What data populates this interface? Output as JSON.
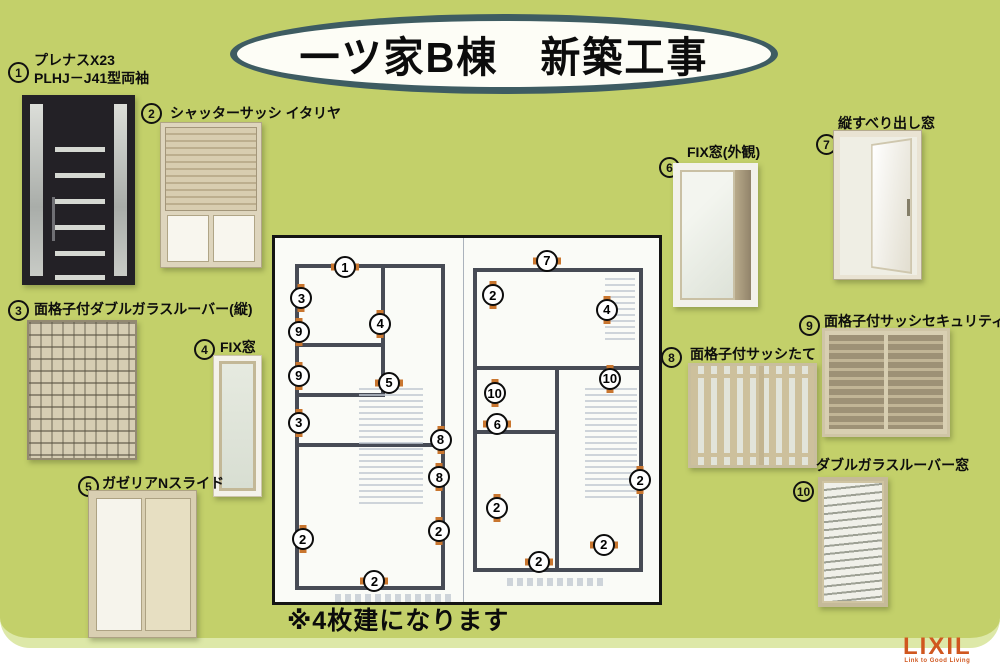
{
  "title": "一ツ家B棟　新築工事",
  "note": "※4枚建になります",
  "colors": {
    "background_green": "#c3d06a",
    "oval_border": "#3e5c62",
    "window_marker_orange": "#c9762f",
    "logo_orange": "#d0571f"
  },
  "logo": {
    "text": "LIXIL",
    "tagline": "Link to Good Living"
  },
  "products": [
    {
      "num": "1",
      "label": "プレナスX23",
      "label2": "PLHJ－J41型両袖"
    },
    {
      "num": "2",
      "label": "シャッターサッシ イタリヤ"
    },
    {
      "num": "3",
      "label": "面格子付ダブルガラスルーバー(縦)"
    },
    {
      "num": "4",
      "label": "FIX窓"
    },
    {
      "num": "5",
      "label": "ガゼリアNスライド"
    },
    {
      "num": "6",
      "label": "FIX窓(外観)"
    },
    {
      "num": "7",
      "label": "縦すべり出し窓"
    },
    {
      "num": "8",
      "label": "面格子付サッシたて"
    },
    {
      "num": "9",
      "label": "面格子付サッシセキュリティー"
    },
    {
      "num": "10",
      "label": "ダブルガラスルーバー窓"
    }
  ],
  "floorplan": {
    "markers": [
      {
        "n": "1",
        "x": 18.2,
        "y": 8.1,
        "dir": "h"
      },
      {
        "n": "3",
        "x": 6.9,
        "y": 16.5,
        "dir": "v"
      },
      {
        "n": "9",
        "x": 6.2,
        "y": 25.7,
        "dir": "v"
      },
      {
        "n": "4",
        "x": 27.4,
        "y": 23.5,
        "dir": "v"
      },
      {
        "n": "9",
        "x": 6.2,
        "y": 37.8,
        "dir": "v"
      },
      {
        "n": "5",
        "x": 29.7,
        "y": 39.7,
        "dir": "h"
      },
      {
        "n": "3",
        "x": 6.2,
        "y": 50.8,
        "dir": "v"
      },
      {
        "n": "8",
        "x": 43.1,
        "y": 55.4,
        "dir": "v"
      },
      {
        "n": "8",
        "x": 42.8,
        "y": 65.7,
        "dir": "v"
      },
      {
        "n": "2",
        "x": 7.2,
        "y": 82.7,
        "dir": "v"
      },
      {
        "n": "2",
        "x": 42.6,
        "y": 80.5,
        "dir": "v"
      },
      {
        "n": "2",
        "x": 25.9,
        "y": 94.3,
        "dir": "h"
      },
      {
        "n": "7",
        "x": 70.8,
        "y": 6.2,
        "dir": "h"
      },
      {
        "n": "2",
        "x": 56.7,
        "y": 15.7,
        "dir": "v"
      },
      {
        "n": "4",
        "x": 86.4,
        "y": 19.7,
        "dir": "v"
      },
      {
        "n": "10",
        "x": 87.2,
        "y": 38.6,
        "dir": "v"
      },
      {
        "n": "10",
        "x": 57.2,
        "y": 42.7,
        "dir": "v"
      },
      {
        "n": "6",
        "x": 57.9,
        "y": 51.1,
        "dir": "h"
      },
      {
        "n": "2",
        "x": 57.7,
        "y": 74.1,
        "dir": "v"
      },
      {
        "n": "2",
        "x": 95.1,
        "y": 66.5,
        "dir": "v"
      },
      {
        "n": "2",
        "x": 85.6,
        "y": 84.3,
        "dir": "h"
      },
      {
        "n": "2",
        "x": 68.7,
        "y": 88.9,
        "dir": "h"
      }
    ]
  }
}
